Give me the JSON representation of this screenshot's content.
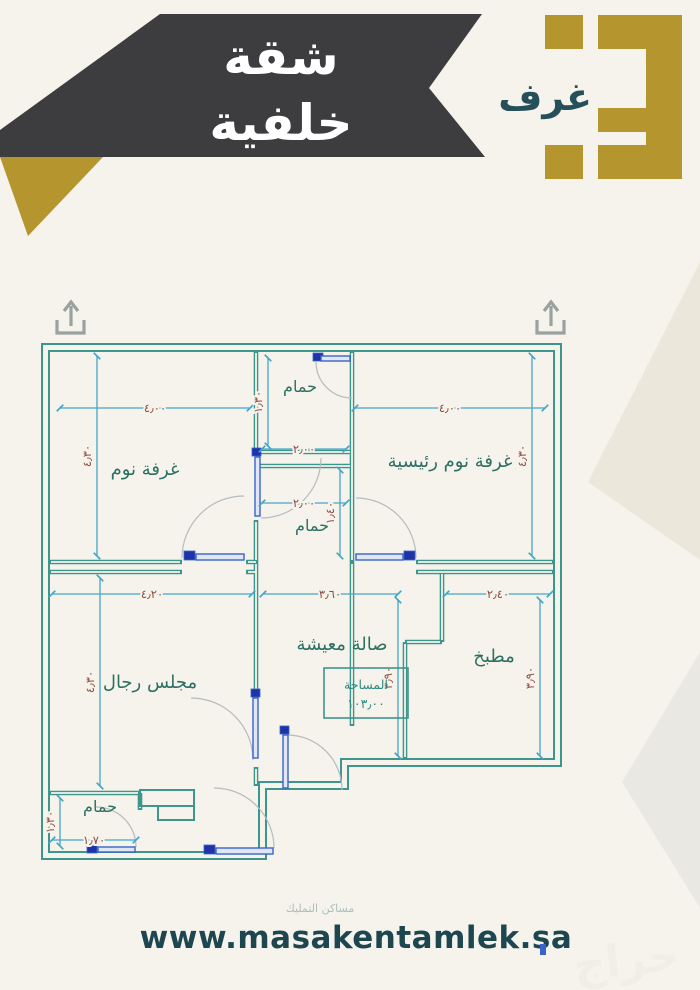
{
  "banner": {
    "line1": "شقة",
    "line2": "خلفية"
  },
  "logo": {
    "count": "3",
    "rooms_label": "غرف"
  },
  "floor_plan": {
    "area_box": {
      "label": "المساحة",
      "value": "١٠٣٫٠٠"
    },
    "rooms": {
      "bedroom": "غرفة نوم",
      "master_bedroom": "غرفة نوم رئيسية",
      "bath_top": "حمام",
      "bath_mid": "حمام",
      "bath_bottom": "حمام",
      "majlis": "مجلس رجال",
      "living": "صالة معيشة",
      "kitchen": "مطبخ"
    },
    "dims": {
      "bedroom_w": "٤٫٠٠",
      "bedroom_h": "٤٫٣٠",
      "master_w": "٤٫٠٠",
      "master_h": "٤٫٣٠",
      "bath_top_w": "٢٫٠٠",
      "bath_top_h": "١٫٣٠",
      "bath_mid_w": "٢٫٠٠",
      "bath_mid_h": "١٫٤٠",
      "majlis_w": "٤٫٢٠",
      "majlis_h": "٤٫٣٠",
      "living_w": "٣٫٦٠",
      "living_h": "٣٫٩٠",
      "kitchen_w": "٢٫٤٠",
      "kitchen_h": "٣٫٩٠",
      "bath_bottom_w": "١٫٧٠",
      "bath_bottom_h": "١٫٣٠"
    }
  },
  "footer": {
    "website": "www.masakentamlek.sa",
    "company_faint": "مساكن التمليك",
    "watermark": "حراج"
  },
  "colors": {
    "background": "#f5f3ec",
    "banner": "#3d3c3e",
    "gold": "#b5952e",
    "teal_text": "#25505a",
    "wall": "#3d968c",
    "dimension_line": "#45a6cb",
    "dimension_text": "#8e4a3e",
    "room_label": "#2e6f63",
    "door_blue": "#3a63c8"
  }
}
